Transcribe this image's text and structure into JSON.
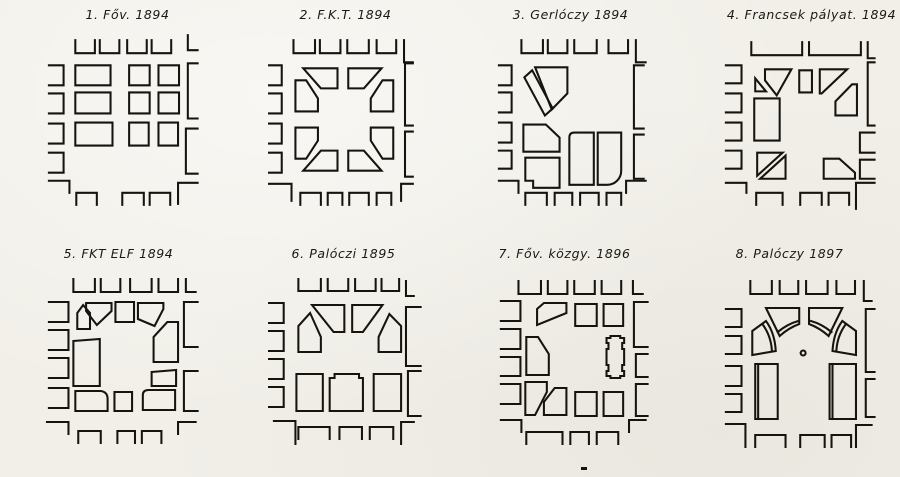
{
  "document": {
    "background": "#f1efe8",
    "ink": "#17140f",
    "description": "Eight competition plans for a city square, 1894-1897"
  },
  "panels": [
    {
      "title": "1. Főv. 1894",
      "paths": [
        "M77,40 V53 H97 V40",
        "M102,40 V53 H122 V40",
        "M130,40 V53 H150 V40",
        "M155,40 V53 H175 V40",
        "M192,35 V50 H202",
        "M50,65 H65 V85 H50",
        "M50,93 H65 V113 H50",
        "M50,123 H65 V143 H50",
        "M50,152 H65 V172 H50",
        "M77,65 H113 V85 H77 Z",
        "M132,65 H153 V85 H132 Z",
        "M162,65 H183 V85 H162 Z",
        "M77,92 H113 V113 H77 Z",
        "M132,92 H153 V113 H132 Z",
        "M162,92 H183 V113 H162 Z",
        "M77,122 H115 V145 H77 Z",
        "M132,122 H152 V145 H132 Z",
        "M162,122 H182 V145 H162 Z",
        "M202,63 H192 V118 H202",
        "M202,128 H190 V173 H202",
        "M50,180 H71 V192",
        "M182,203 V182 H202",
        "M78,204 V192 H99 V204",
        "M125,204 V192 H147 V204",
        "M153,204 V192 H174 V204"
      ]
    },
    {
      "title": "2. F.K.T. 1894",
      "paths": [
        "M70,40 V53 H92 V40",
        "M97,40 V53 H118 V40",
        "M125,40 V53 H147 V40",
        "M155,40 V53 H175 V40",
        "M183,40 V62 H192",
        "M45,65 H58 V85 H45",
        "M45,93 H58 V113 H45",
        "M45,123 H58 V143 H45",
        "M45,152 H58 V172 H45",
        "M80,68 H115 V88 H98 Z",
        "M126,68 H160 L142,88 H126 Z",
        "M72,80 H83 L95,98 V111 H72 Z",
        "M161,80 H172 V111 H149 V98 Z",
        "M72,127 H95 V140 L83,158 H72 Z",
        "M149,127 H172 V158 H161 L149,140 Z",
        "M98,150 H115 V170 H80 Z",
        "M126,150 H142 L160,170 H126 Z",
        "M192,63 H184 V125 H192",
        "M192,131 H184 V176 H192",
        "M45,183 H68 V200",
        "M180,200 V183 H192",
        "M77,204 V192 H98 V204",
        "M105,204 V192 H120 V204",
        "M127,204 V192 H147 V204",
        "M155,204 V192 H170 V204"
      ]
    },
    {
      "title": "3. Gerlóczy 1894",
      "paths": [
        "M73,40 V53 H95 V40",
        "M100,40 V53 H120 V40",
        "M127,40 V53 H150 V40",
        "M162,40 V53 H182 V40",
        "M190,40 V62 H200",
        "M50,65 H63 V85 H50",
        "M50,92 H63 V112 H50",
        "M50,122 H63 V142 H50",
        "M50,150 H63 V168 H50",
        "M87,67 H120 V93 L104,109 Z",
        "M84,70 L105,108 L97,115 L76,77 Z",
        "M75,124 H98 L112,137 V151 H75 Z",
        "M77,157 H112 V187 H85 V180 H77 Z",
        "M127,132 H147 V184 H122 V137 Q122,132 127,132 Z",
        "M151,132 H175 V170 A14,14 0 0 1 161,184 H151 Z",
        "M198,65 H188 V128 H198",
        "M198,134 H188 V178 H198",
        "M50,180 H70 V192",
        "M180,192 V180 H200",
        "M77,204 V192 H99 V204",
        "M107,204 V192 H125 V204",
        "M133,204 V192 H152 V204",
        "M160,204 V192 H175 V204"
      ]
    },
    {
      "title": "4. Francsek pályat. 1894",
      "paths": [
        "M78,42 V55 H130 V42",
        "M137,42 V55 H190 V42",
        "M197,42 V58 H204",
        "M52,65 H68 V83 H52",
        "M52,93 H68 V112 H52",
        "M52,122 H68 V140 H52",
        "M52,150 H68 V168 H52",
        "M92,69 H119 L104,95 L92,80 Z",
        "M82,78 L93,91 H82 Z",
        "M127,70 H140 V92 H127 Z",
        "M148,69 H176 L150,93 H148 Z",
        "M164,101 L181,84 H186 V115 H164 Z",
        "M81,98 H107 V140 H81 Z",
        "M84,152 H110 L84,175 Z",
        "M113,155 V178 H87 Z",
        "M152,158 H168 L184,172 V178 H152 Z",
        "M204,62 H197 V125 H204",
        "M204,132 H189 V152 H204",
        "M204,159 H189 V178 H204",
        "M52,182 H73 V192",
        "M185,208 V182 H204",
        "M83,204 V192 H110 V204",
        "M128,204 V192 H150 V204",
        "M157,204 V192 H178 V204"
      ]
    },
    {
      "title": "5. FKT ELF 1894",
      "paths": [
        "M75,40 V53 H97 V40",
        "M103,40 V53 H123 V40",
        "M133,40 V53 H155 V40",
        "M162,40 V53 H182 V40",
        "M190,40 V53 H200",
        "M50,63 H70 V83 H50",
        "M50,91 H70 V111 H50",
        "M50,119 H70 V139 H50",
        "M50,149 H70 V169 H50",
        "M79,74 L85,66 L92,74 V90 H79 Z",
        "M88,64 H114 V72 L99,86 L88,72 Z",
        "M118,63 H137 V83 H118 Z",
        "M141,64 H167 V70 L158,87 L141,80 Z",
        "M157,98 L171,83 H182 V123 H157 Z",
        "M75,102 L102,100 V147 H75 Z",
        "M155,133 L180,131 V147 H155 Z",
        "M77,152 H103 Q110,153 110,160 V172 H77 Z",
        "M117,153 H135 V172 H117 Z",
        "M152,151 H179 V171 H146 V156 Q146,151 152,151 Z",
        "M202,63 H188 V108 H202",
        "M202,132 H188 V172 H202",
        "M48,183 H70 V195",
        "M182,195 V183 H200",
        "M80,204 V192 H103 V204",
        "M120,204 V192 H138 V204",
        "M145,204 V192 H165 V204"
      ]
    },
    {
      "title": "6. Palóczi 1895",
      "paths": [
        "M75,40 V52 H98 V40",
        "M105,40 V52 H126 V40",
        "M133,40 V52 H154 V40",
        "M160,40 V52 H178 V40",
        "M185,42 V57 H193",
        "M45,64 H60 V84 H45",
        "M45,92 H60 V112 H45",
        "M45,120 H60 V140 H45",
        "M45,148 H60 V168 H45",
        "M87,74 L98,98 V113 H75 V87 Z",
        "M89,66 H122 V93 H111 Z",
        "M130,66 H161 L141,93 H130 Z",
        "M168,75 L180,87 V113 H157 V98 Z",
        "M73,135 H100 V172 H73 Z",
        "M107,139 H112 V135 H137 V139 H141 V172 H107 Z",
        "M152,135 H180 V172 H152 Z",
        "M200,68 H185 V127 H200",
        "M200,132 H187 V177 H200",
        "M50,182 H72 V205",
        "M180,205 V183 H193",
        "M75,200 V188 H107 V200",
        "M117,200 V188 H140 V200",
        "M148,200 V188 H172 V200"
      ]
    },
    {
      "title": "7. Főv. közgy. 1896",
      "paths": [
        "M70,42 V55 H93 V42",
        "M100,42 V55 H120 V42",
        "M127,42 V55 H148 V42",
        "M155,42 V55 H175 V42",
        "M187,42 V55 H197",
        "M52,62 H72 V82 H52",
        "M52,90 H72 V110 H52",
        "M52,118 H72 V137 H52",
        "M52,145 H72 V165 H52",
        "M96,64 H119 V74 L89,86 V70 Z",
        "M78,98 H90 L101,115 V136 H78 Z",
        "M128,65 H150 V87 H128 Z",
        "M157,65 H177 V87 H157 Z",
        "M160,99 H164 V97 H174 V99 H178 V104 H176 V110 H178 V126 H176 V132 H178 V137 H174 V139 H164 V137 H160 V132 H162 V126 H160 V110 H162 V104 H160 Z",
        "M77,143 H99 V153 L87,176 H77 Z",
        "M107,149 H119 V176 H96 V163 Z",
        "M128,153 H150 V177 H128 Z",
        "M157,153 H177 V177 H157 Z",
        "M202,63 H188 V108 H202",
        "M202,115 H190 V138 H202",
        "M202,145 H190 V177 H202",
        "M52,181 H73 V193",
        "M183,193 V181 H200",
        "M78,205 V193 H115 V205",
        "M123,205 V193 H142 V205",
        "M150,205 V193 H172 V205"
      ]
    },
    {
      "title": "8. Palóczy 1897",
      "paths": [
        "M77,42 V55 H99 V42",
        "M107,42 V55 H126 V42",
        "M134,42 V55 H156 V42",
        "M165,42 V55 H184 V42",
        "M193,42 V62 H201",
        "M52,70 H68 V88 H52",
        "M52,97 H68 V115 H52",
        "M52,127 H68 V147 H52",
        "M52,155 H68 V173 H52",
        "M93,69 H127 V85 Q116,89 107,97 Z",
        "M126,82 Q115,85 105,93",
        "M171,69 H137 V85 Q148,89 157,97 Z",
        "M139,82 Q150,85 160,93",
        "M79,92 L93,82 Q102,94 103,112 L79,116 Z",
        "M90,86 Q98,97 99,111",
        "M185,92 L171,82 Q162,94 161,112 L185,116 Z",
        "M174,86 Q166,97 165,111",
        "M128.5,114 a2.5,2.5 0 1 0 5,0 a2.5,2.5 0 1 0 -5,0",
        "M82,125 H105 V180 H82 Z",
        "M85,125 V180",
        "M158,125 H185 V180 H158 Z",
        "M161,125 V180",
        "M204,70 H195 V133 H204",
        "M204,140 H195 V178 H204",
        "M52,185 H72 V208",
        "M185,208 V186 H201",
        "M82,208 V196 H113 V208",
        "M128,208 V196 H153 V208",
        "M160,208 V196 H180 V208"
      ]
    }
  ]
}
